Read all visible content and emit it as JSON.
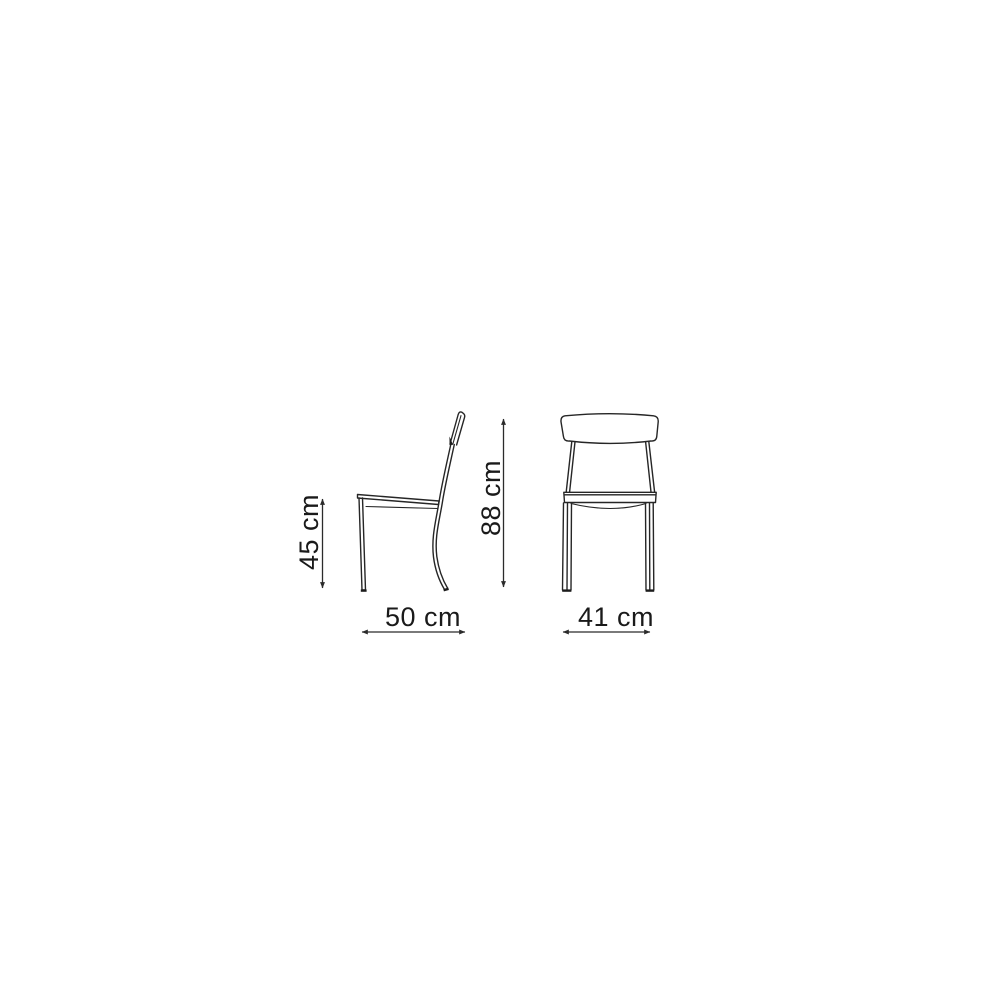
{
  "diagram": {
    "subject": "chair-technical-dimension-drawing",
    "background": "#ffffff",
    "stroke_color": "#262626",
    "text_color": "#1a1a1a",
    "views": [
      {
        "id": "side-view",
        "horizontal_dimension": "50 cm",
        "vertical_dimension": "45 cm"
      },
      {
        "id": "front-view",
        "horizontal_dimension": "41 cm",
        "vertical_dimension": "88 cm"
      }
    ],
    "dimensions": {
      "seat_height_label": "45 cm",
      "depth_label": "50 cm",
      "overall_height_label": "88 cm",
      "width_label": "41 cm"
    }
  }
}
